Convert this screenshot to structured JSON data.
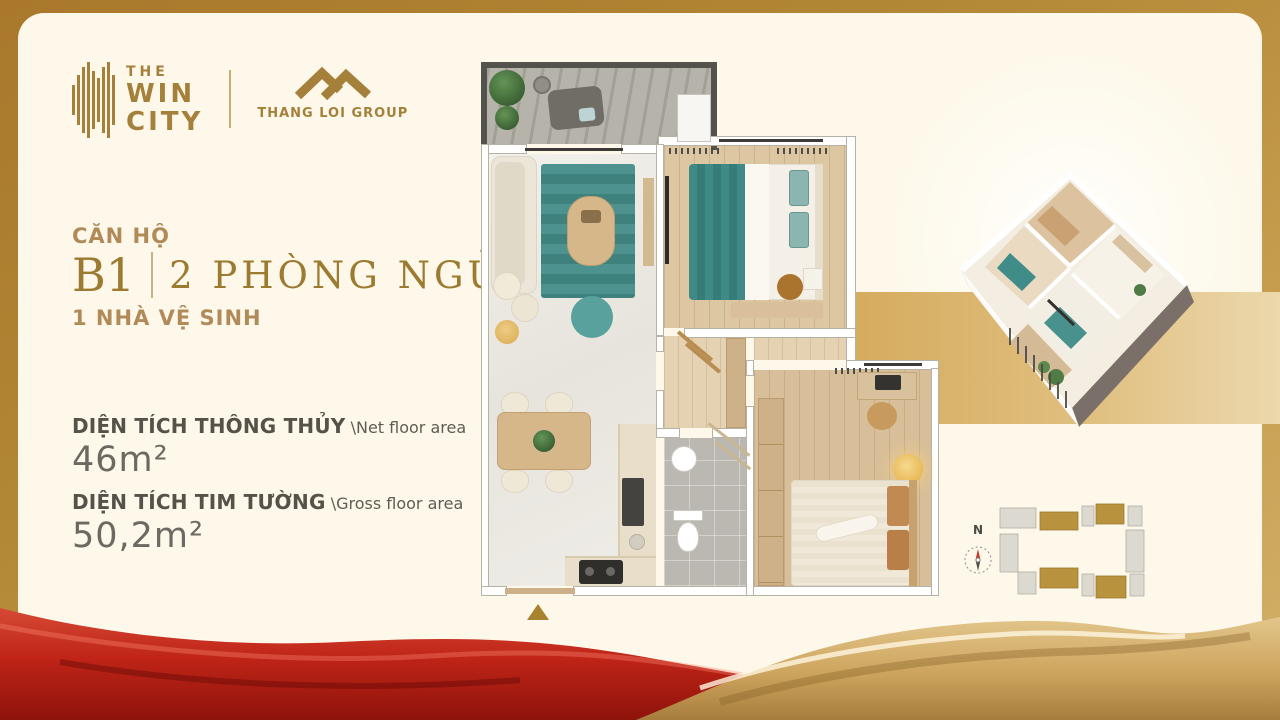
{
  "brand": {
    "the_win_city": {
      "line1": "THE",
      "line2": "WIN",
      "line3": "CITY"
    },
    "thang_loi_group": {
      "label": "THANG LOI GROUP"
    }
  },
  "unit": {
    "label": "CĂN HỘ",
    "code": "B1",
    "bedrooms": "2 PHÒNG NGỦ",
    "bathrooms": "1 NHÀ VỆ SINH"
  },
  "areas": [
    {
      "label": "DIỆN TÍCH THÔNG THỦY",
      "sublabel": "\\Net floor area",
      "value": "46m²"
    },
    {
      "label": "DIỆN TÍCH TIM TƯỜNG",
      "sublabel": "\\Gross floor area",
      "value": "50,2m²"
    }
  ],
  "compass": {
    "north_label": "N"
  },
  "colors": {
    "frame_gold": "#a9782c",
    "frame_gold_light": "#d3b06a",
    "cream": "#fdf8e9",
    "brand_gold": "#a5803a",
    "title_gold": "#9c7a2f",
    "tan_text": "#b08a58",
    "dark_text": "#55524a",
    "value_text": "#6c6962",
    "band_gold": "#d5ab5e",
    "teal": "#47908c",
    "wood": "#dcc6a2",
    "red_wave": "#c0281c",
    "gold_wave": "#c9a35c",
    "marker_gold": "#a9822f"
  }
}
